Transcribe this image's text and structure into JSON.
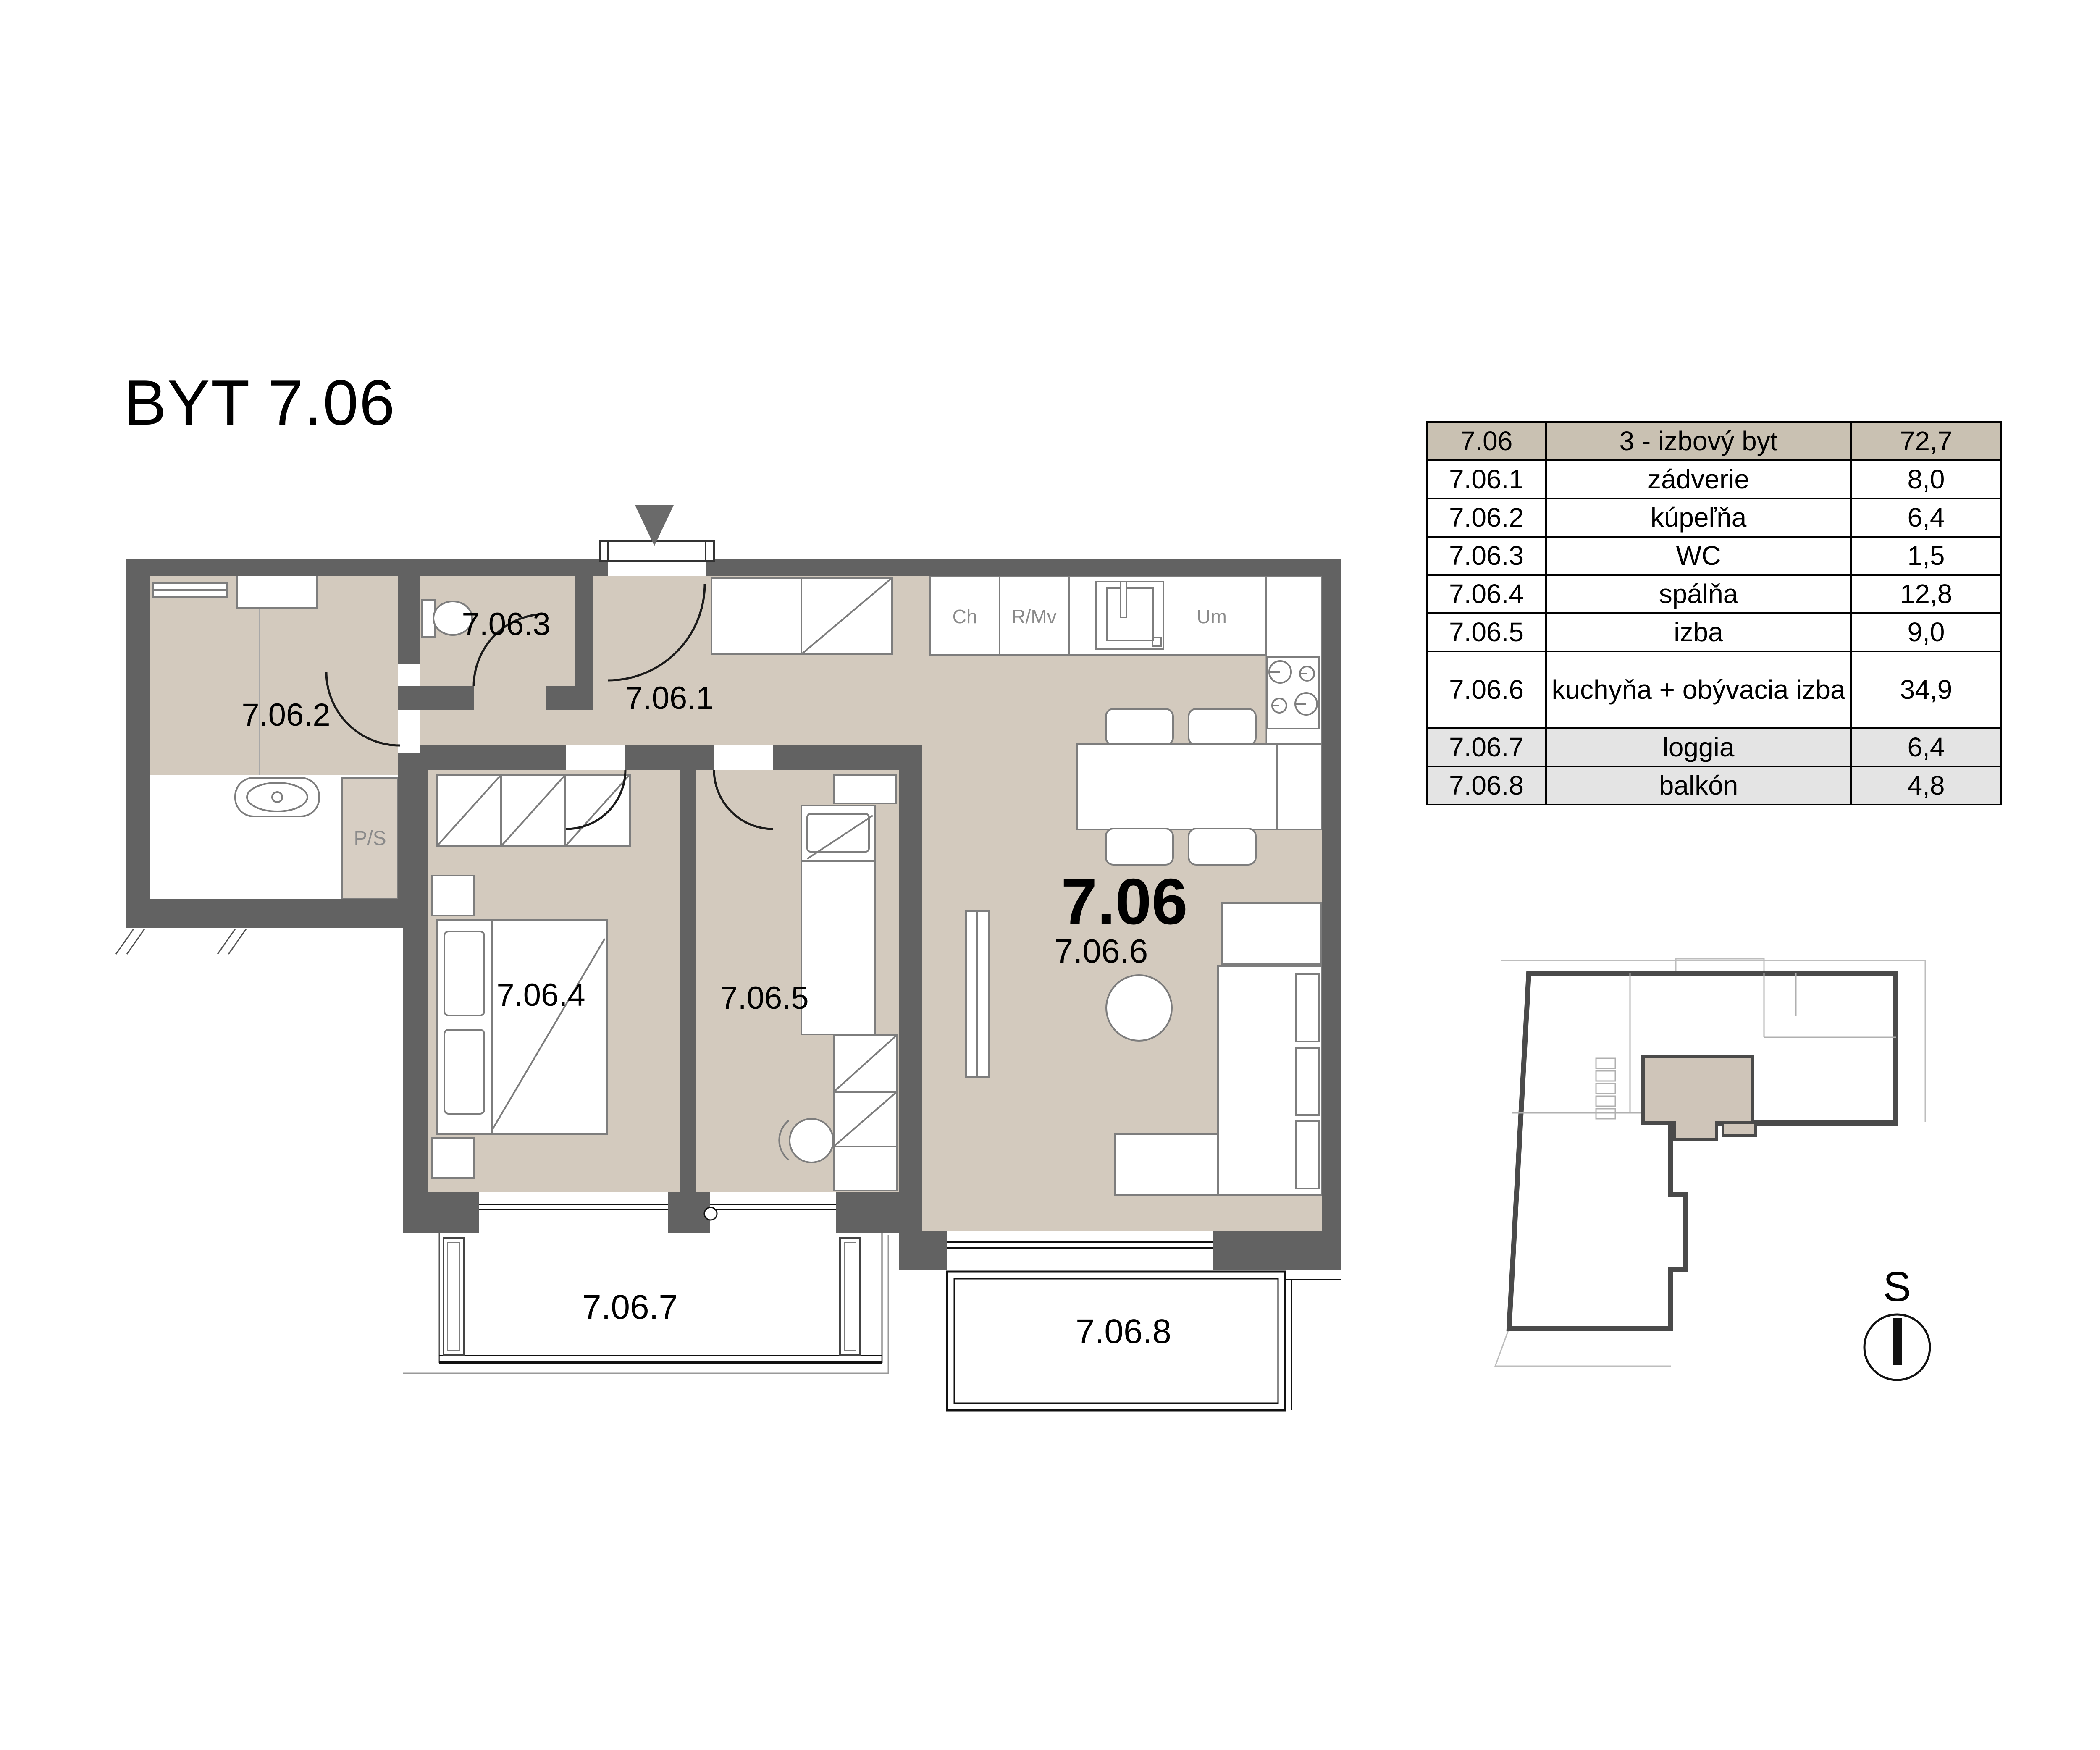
{
  "title": "BYT 7.06",
  "table": {
    "header": {
      "id": "7.06",
      "name": "3 - izbový byt",
      "area": "72,7"
    },
    "rows": [
      {
        "id": "7.06.1",
        "name": "zádverie",
        "area": "8,0"
      },
      {
        "id": "7.06.2",
        "name": "kúpeľňa",
        "area": "6,4"
      },
      {
        "id": "7.06.3",
        "name": "WC",
        "area": "1,5"
      },
      {
        "id": "7.06.4",
        "name": "spálňa",
        "area": "12,8"
      },
      {
        "id": "7.06.5",
        "name": "izba",
        "area": "9,0"
      },
      {
        "id": "7.06.6",
        "name": "kuchyňa + obývacia izba",
        "area": "34,9"
      },
      {
        "id": "7.06.7",
        "name": "loggia",
        "area": "6,4"
      },
      {
        "id": "7.06.8",
        "name": "balkón",
        "area": "4,8"
      }
    ]
  },
  "plan": {
    "labels": {
      "hall": "7.06.1",
      "bathroom": "7.06.2",
      "wc": "7.06.3",
      "bedroom": "7.06.4",
      "room": "7.06.5",
      "apartment": "7.06",
      "living": "7.06.6",
      "loggia": "7.06.7",
      "balcony": "7.06.8"
    },
    "fixtures": {
      "cabinet1": "Ch",
      "cabinet2": "R/Mv",
      "sink": "Um",
      "washer": "P/S"
    }
  },
  "compass": {
    "north_label": "S"
  },
  "colors": {
    "wall": "#626262",
    "room_fill": "#d3cabe",
    "table_header_bg": "#c9c1b2",
    "table_outdoor_bg": "#e4e4e4",
    "minimap_highlight": "#cfc5b9",
    "furniture_stroke": "#7d7d7d"
  }
}
